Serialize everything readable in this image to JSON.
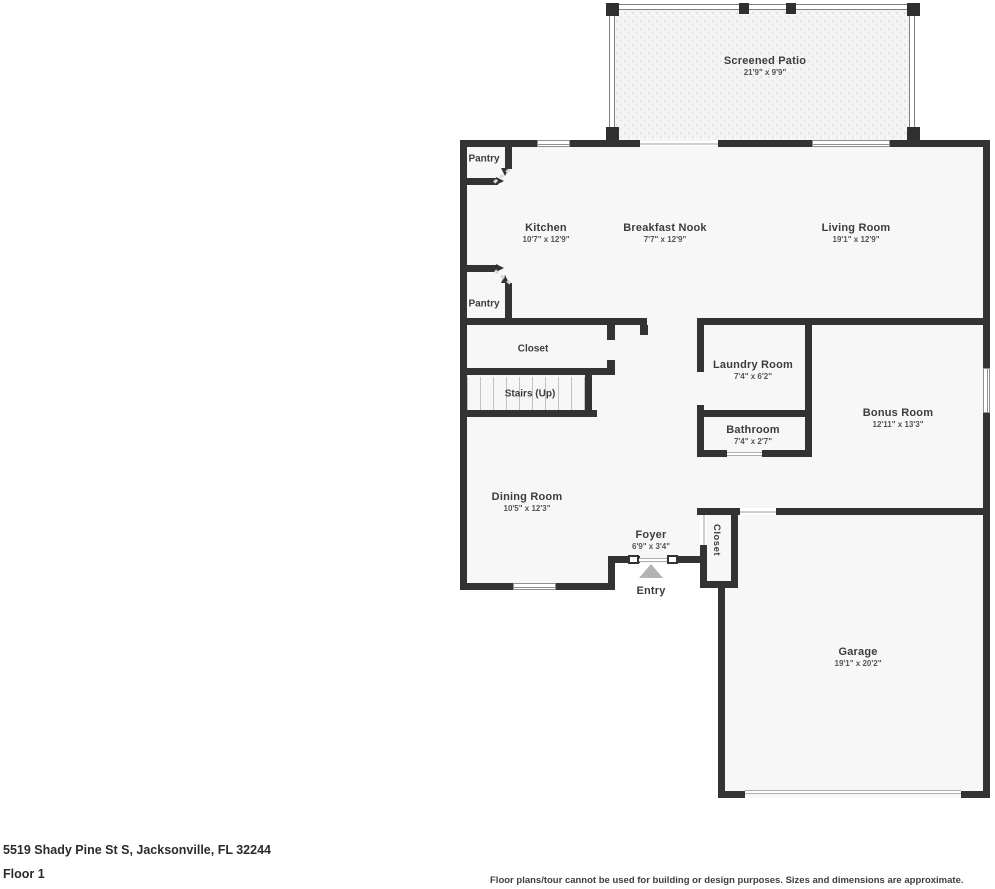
{
  "title": "Floor plan",
  "colors": {
    "wall": "#333333",
    "room_fill": "#f7f7f7",
    "label_text": "#3d3d3d",
    "dims_text": "#555555",
    "entry_marker": "#b3b3b3"
  },
  "rooms": {
    "screened_patio": {
      "name": "Screened Patio",
      "dims": "21'9\" x 9'9\""
    },
    "kitchen": {
      "name": "Kitchen",
      "dims": "10'7\" x 12'9\""
    },
    "breakfast_nook": {
      "name": "Breakfast Nook",
      "dims": "7'7\" x 12'9\""
    },
    "living_room": {
      "name": "Living Room",
      "dims": "19'1\" x 12'9\""
    },
    "pantry_top": {
      "name": "Pantry"
    },
    "pantry_bottom": {
      "name": "Pantry"
    },
    "closet_hall": {
      "name": "Closet"
    },
    "stairs": {
      "name": "Stairs (Up)"
    },
    "laundry_room": {
      "name": "Laundry Room",
      "dims": "7'4\" x 6'2\""
    },
    "bathroom": {
      "name": "Bathroom",
      "dims": "7'4\" x 2'7\""
    },
    "bonus_room": {
      "name": "Bonus Room",
      "dims": "12'11\" x 13'3\""
    },
    "dining_room": {
      "name": "Dining Room",
      "dims": "10'5\" x 12'3\""
    },
    "foyer": {
      "name": "Foyer",
      "dims": "6'9\" x 3'4\""
    },
    "entry": {
      "name": "Entry"
    },
    "closet_entry": {
      "name": "Closet"
    },
    "garage": {
      "name": "Garage",
      "dims": "19'1\" x 20'2\""
    }
  },
  "footer": {
    "address": "5519 Shady Pine St S, Jacksonville, FL 32244",
    "floor_label": "Floor 1",
    "disclaimer": "Floor plans/tour cannot be used for building or design purposes. Sizes and dimensions are approximate."
  }
}
